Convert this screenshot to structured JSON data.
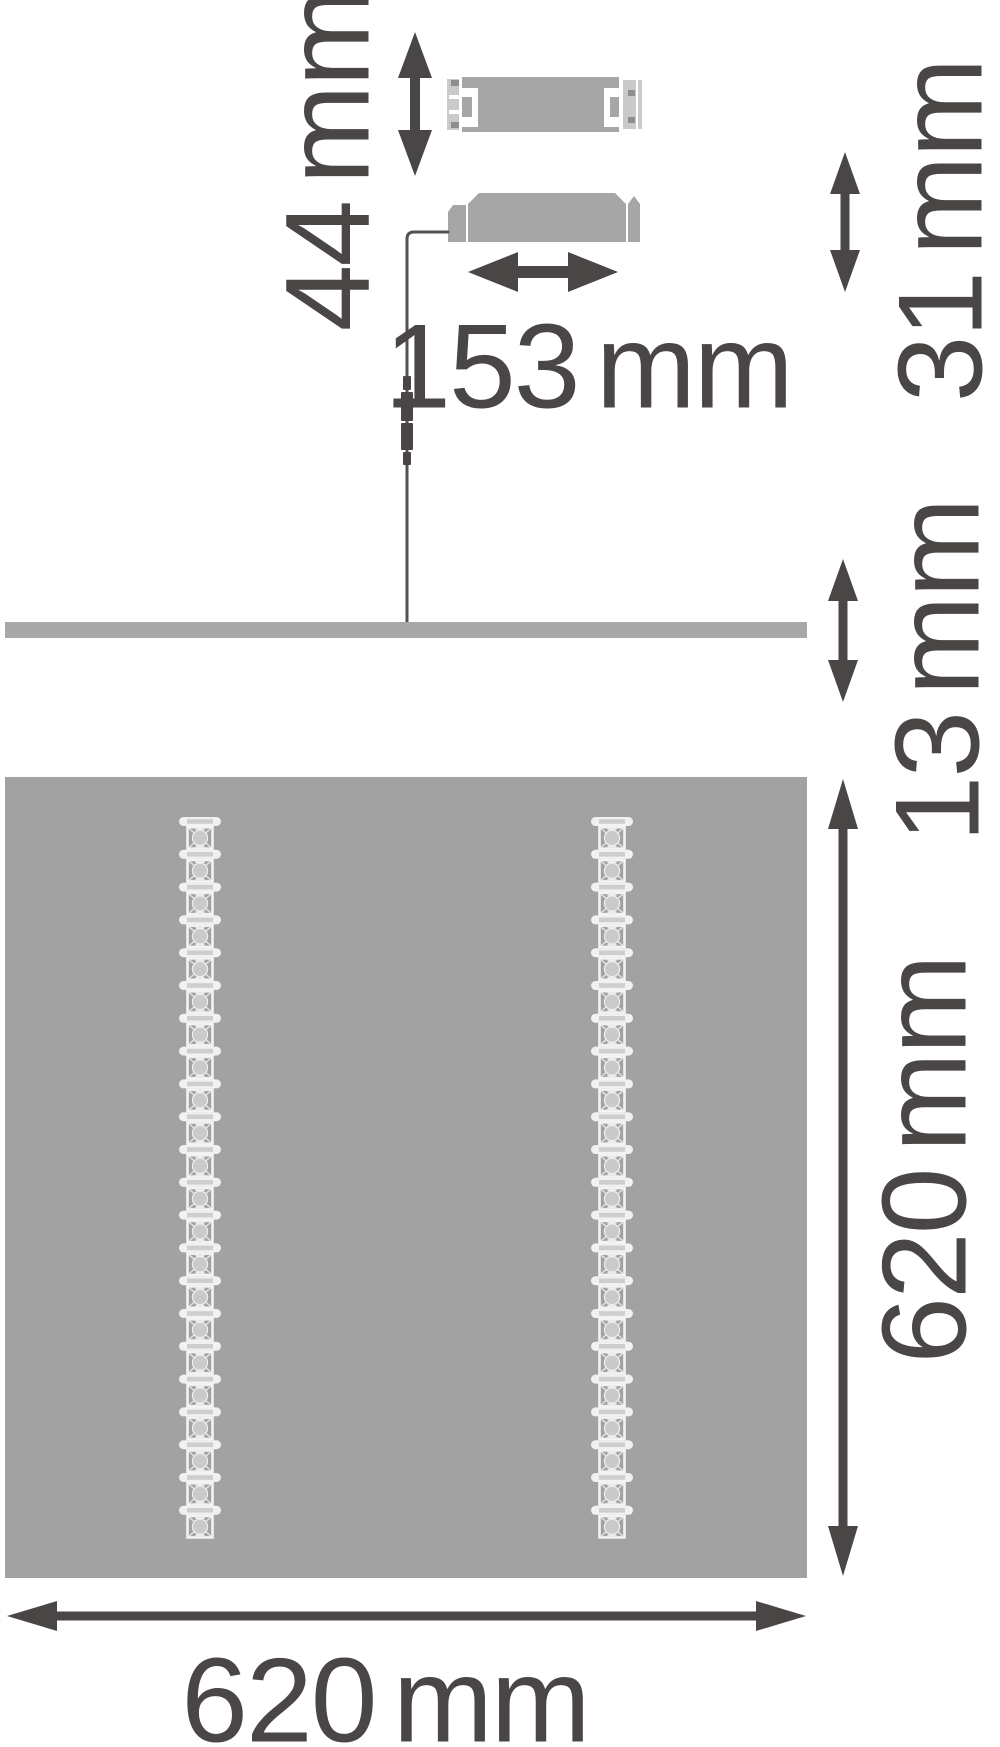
{
  "drawing": {
    "title": "LED panel luminaire dimension drawing",
    "labels": {
      "dim_44": "44 mm",
      "dim_31": "31 mm",
      "dim_153": "153 mm",
      "dim_13": "13 mm",
      "dim_620_vertical": "620 mm",
      "dim_620_horizontal": "620 mm"
    },
    "panel": {
      "led_strip_count": 2,
      "modules_per_strip": 22
    },
    "colors": {
      "ink": "#4a4645",
      "panel_fill": "#a3a2a2",
      "panel_side_fill": "#a9a8a8",
      "driver_fill": "#a7a6a6",
      "driver_cap_fill": "#cbcac9",
      "cable": "#56514f",
      "led_white": "#f2f1f1",
      "led_circle": "#cbcaca",
      "background": "#ffffff"
    }
  }
}
